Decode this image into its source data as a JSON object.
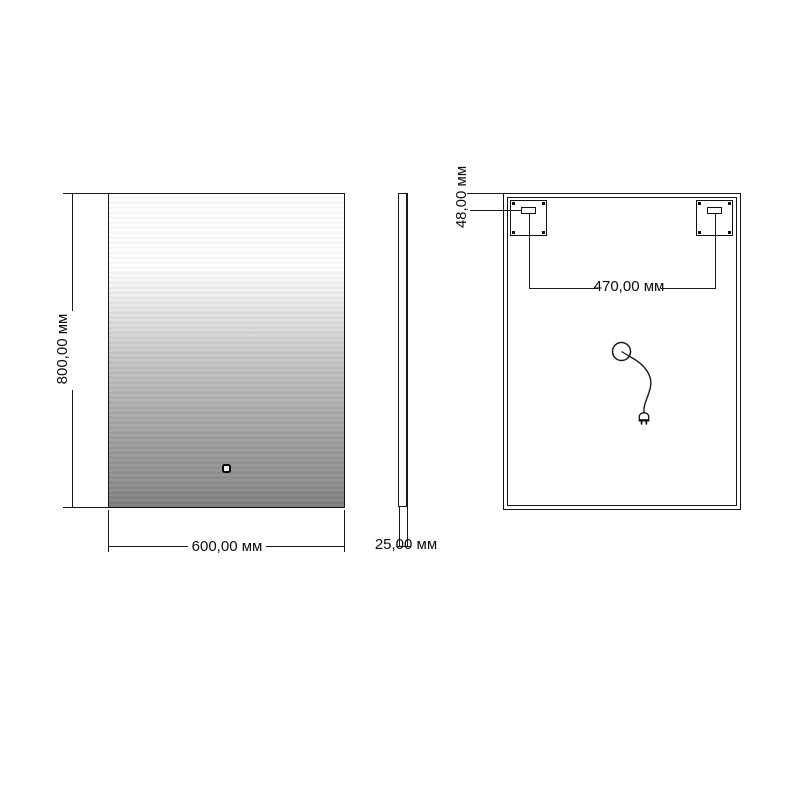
{
  "meta": {
    "units": "мм"
  },
  "labels": {
    "height": "800,00 мм",
    "width": "600,00 мм",
    "thickness": "25,00 мм",
    "bracket_offset": "48,00 мм",
    "bracket_spacing": "470,00 мм"
  },
  "dimensions": {
    "height_mm": 800,
    "width_mm": 600,
    "thickness_mm": 25,
    "bracket_offset_mm": 48,
    "bracket_spacing_mm": 470
  },
  "colors": {
    "line": "#1a1a1a",
    "mirror_gradient_top": "#ffffff",
    "mirror_gradient_bottom": "#797979",
    "background": "#ffffff"
  }
}
